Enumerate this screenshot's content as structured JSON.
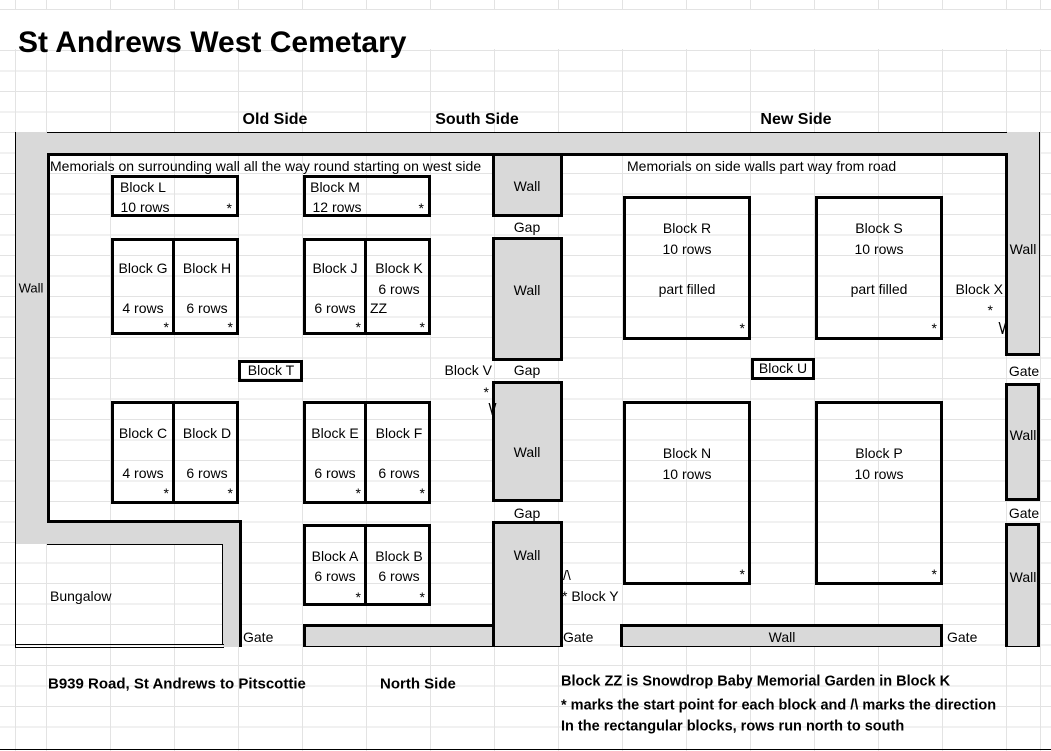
{
  "title": "St Andrews West Cemetary",
  "compass": {
    "old": "Old Side",
    "south": "South Side",
    "new": "New Side",
    "north": "North Side"
  },
  "notes": {
    "old_memorials": "Memorials on surrounding wall all the way round starting on west side",
    "new_memorials": "Memorials on side walls part way from road",
    "road": "B939 Road, St Andrews to Pitscottie"
  },
  "legend": {
    "zz": "Block ZZ is Snowdrop Baby Memorial Garden in Block K",
    "start": "* marks the start point for each block and /\\ marks the direction",
    "rows_dir": "In the rectangular blocks, rows run north to south"
  },
  "walls": {
    "wall": "Wall",
    "gap": "Gap",
    "gate": "Gate"
  },
  "bungalow": "Bungalow",
  "markers": {
    "star": "*",
    "down": "\\/",
    "up": "/\\"
  },
  "blocks": {
    "L": {
      "name": "Block L",
      "rows": "10 rows"
    },
    "M": {
      "name": "Block M",
      "rows": "12 rows"
    },
    "G": {
      "name": "Block G",
      "rows": "4 rows"
    },
    "H": {
      "name": "Block H",
      "rows": "6 rows"
    },
    "J": {
      "name": "Block J",
      "rows": "6 rows"
    },
    "K": {
      "name": "Block K",
      "rows": "6 rows",
      "zz": "ZZ"
    },
    "T": {
      "name": "Block T"
    },
    "U": {
      "name": "Block U"
    },
    "C": {
      "name": "Block C",
      "rows": "4 rows"
    },
    "D": {
      "name": "Block D",
      "rows": "6 rows"
    },
    "E": {
      "name": "Block E",
      "rows": "6 rows"
    },
    "F": {
      "name": "Block F",
      "rows": "6 rows"
    },
    "A": {
      "name": "Block A",
      "rows": "6 rows"
    },
    "B": {
      "name": "Block B",
      "rows": "6 rows"
    },
    "R": {
      "name": "Block R",
      "rows": "10 rows",
      "fill": "part filled"
    },
    "S": {
      "name": "Block S",
      "rows": "10 rows",
      "fill": "part filled"
    },
    "N": {
      "name": "Block N",
      "rows": "10 rows"
    },
    "P": {
      "name": "Block P",
      "rows": "10 rows"
    },
    "V": {
      "name": "Block V"
    },
    "X": {
      "name": "Block X"
    },
    "Y": {
      "name": "* Block Y"
    }
  },
  "colors": {
    "wall_fill": "#d9d9d9",
    "border": "#000000",
    "gridline": "#e3e3e3"
  }
}
